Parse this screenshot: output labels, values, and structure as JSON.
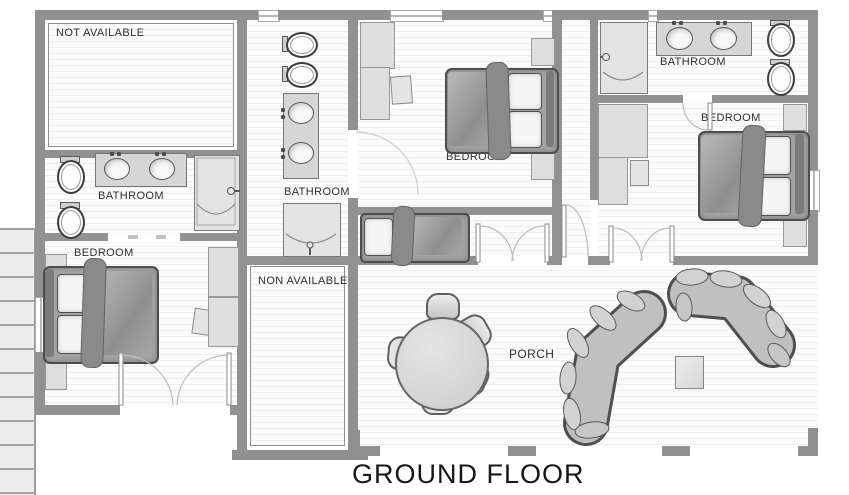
{
  "title": "GROUND FLOOR",
  "rooms": {
    "top_left": {
      "label": "NOT AVAILABLE"
    },
    "bathroom_left": {
      "label": "BATHROOM"
    },
    "bedroom_left": {
      "label": "BEDROOM"
    },
    "bathroom_middle": {
      "label": "BATHROOM"
    },
    "non_available": {
      "label": "NON AVAILABLE"
    },
    "bedroom_middle": {
      "label": "BEDROOM"
    },
    "bathroom_right": {
      "label": "BATHROOM"
    },
    "bedroom_right": {
      "label": "BEDROOM"
    },
    "porch": {
      "label": "PORCH"
    }
  },
  "colors": {
    "wall": "#919191",
    "floor_stripe": "#eeeeee",
    "bed_fill": "#a3a3a3",
    "furniture_fill": "#dedede",
    "text": "#2f2f2f"
  },
  "fixtures": [
    "double-bed",
    "single-bed",
    "toilet",
    "sink-vanity",
    "shower",
    "round-dining-table",
    "dining-chair",
    "sectional-sofa",
    "coffee-table",
    "staircase",
    "wardrobe",
    "nightstand",
    "door-swing",
    "window"
  ]
}
